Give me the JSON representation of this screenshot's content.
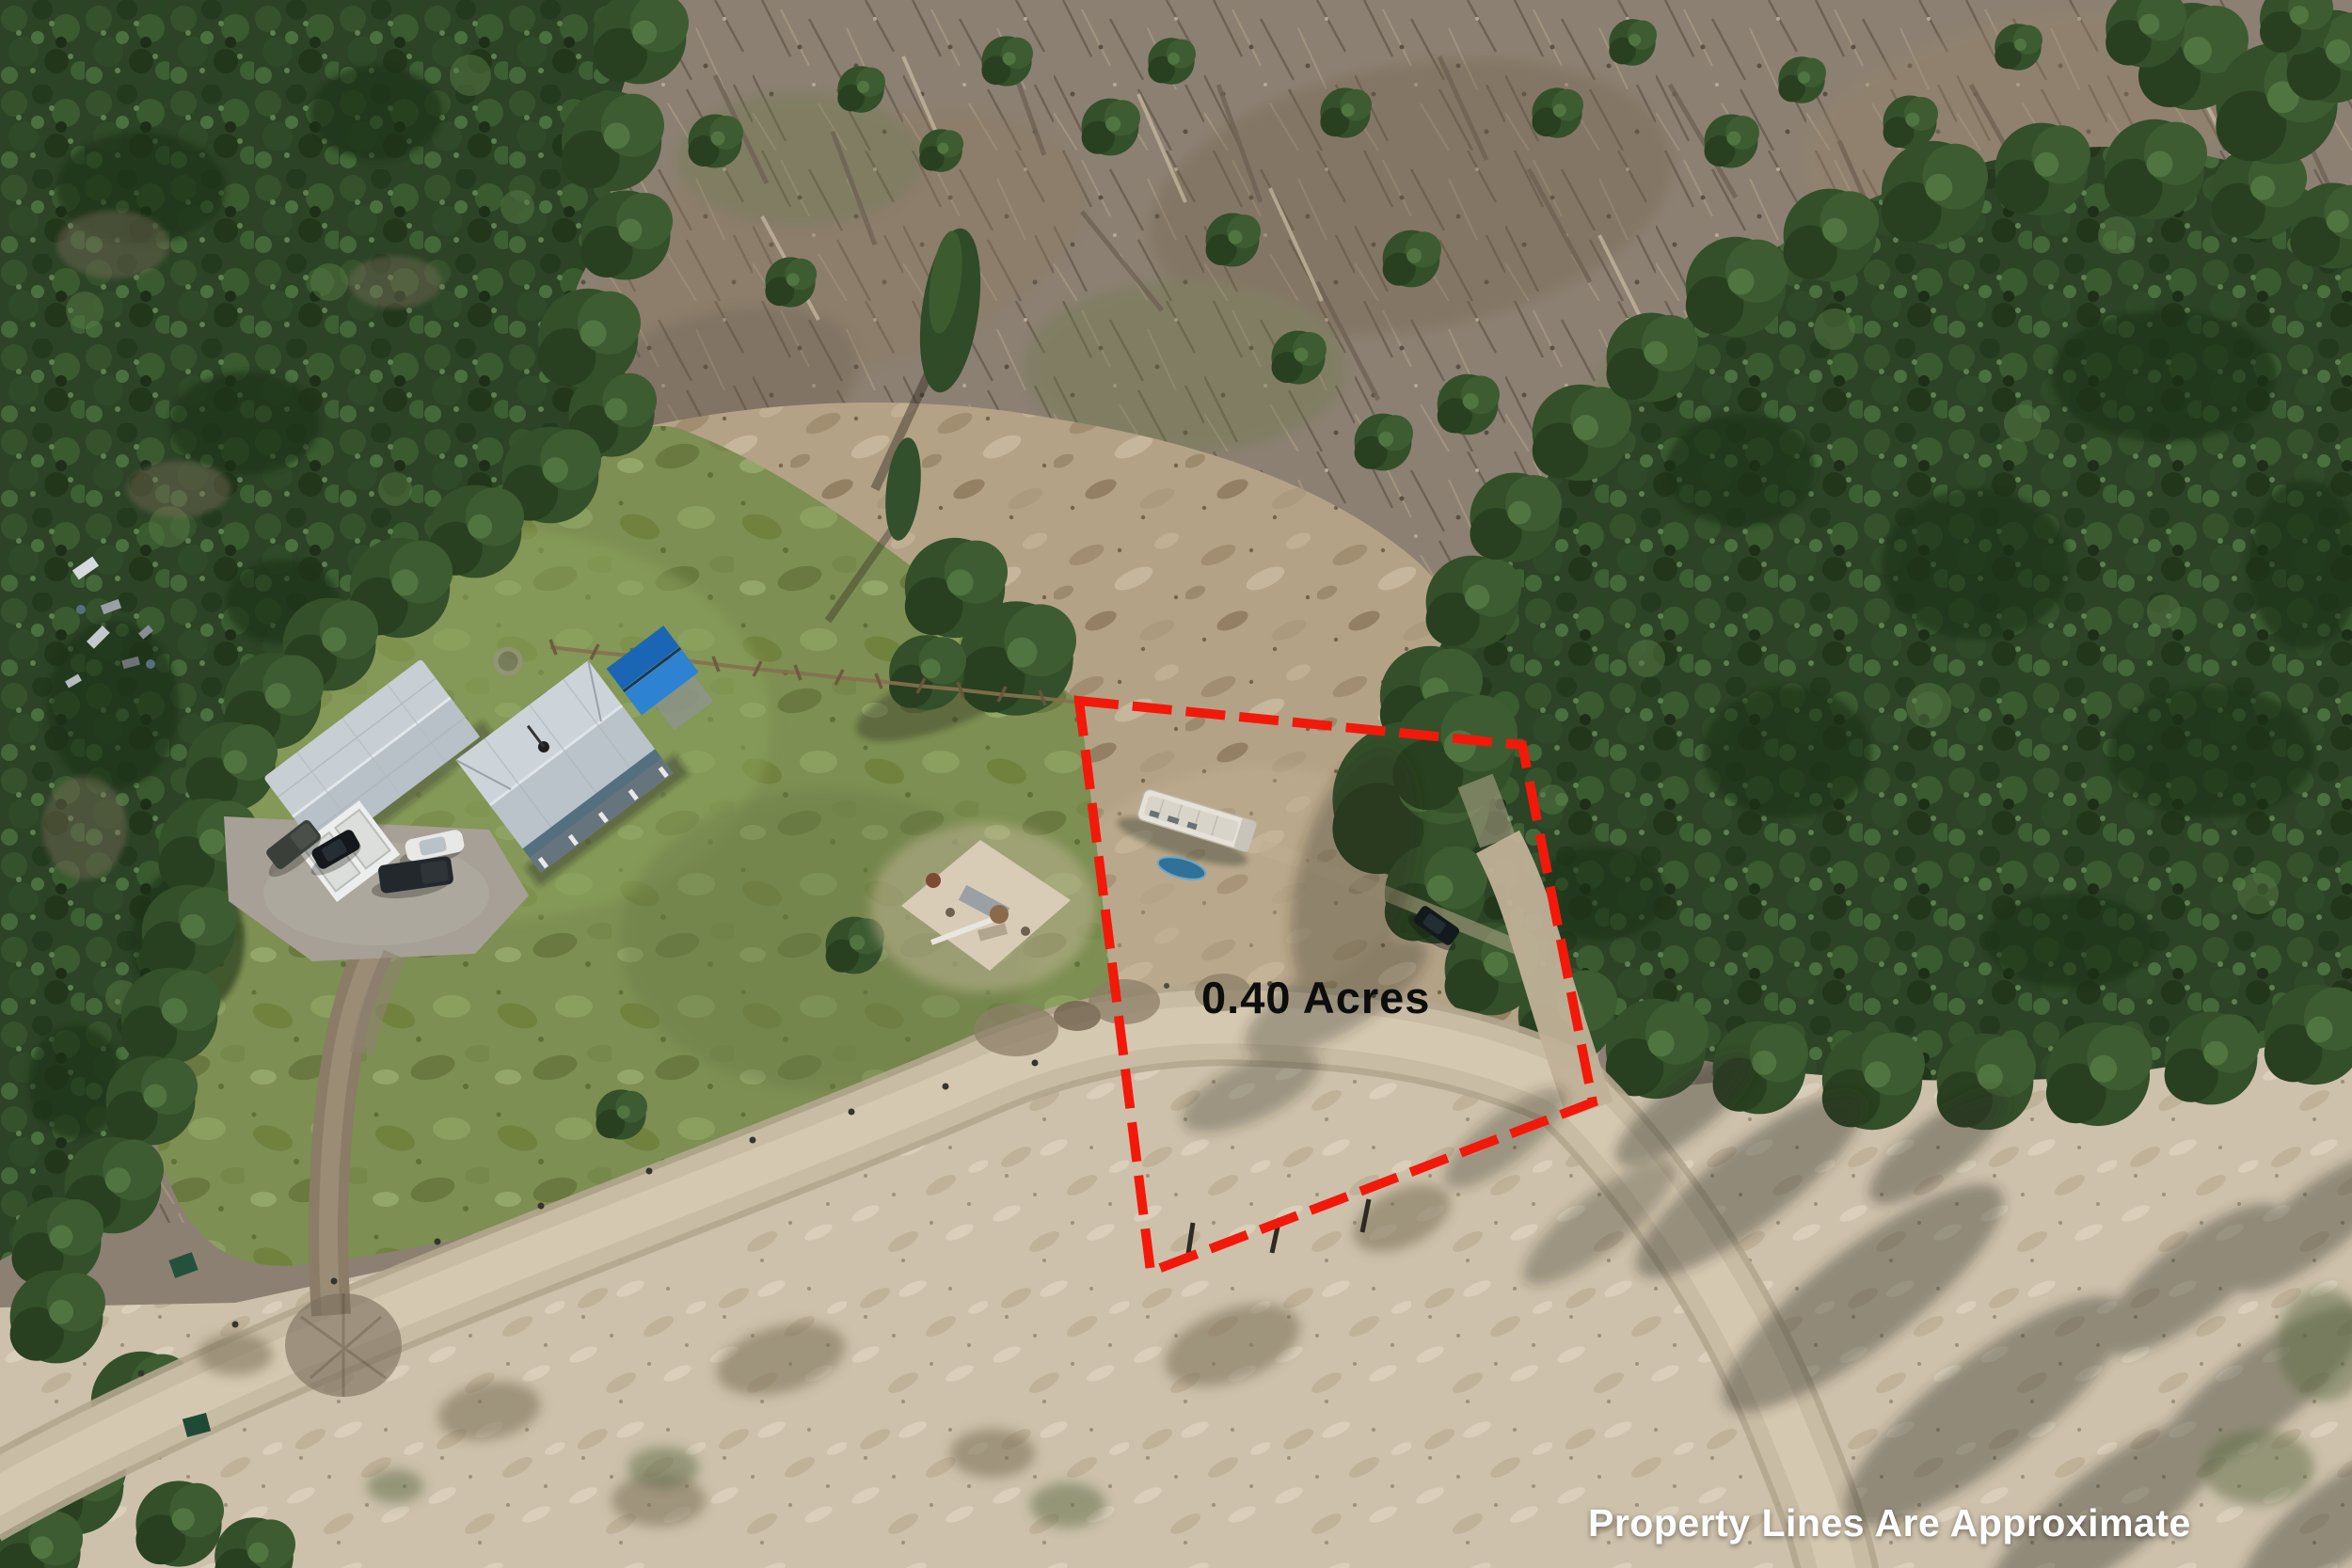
{
  "annotation": {
    "acreage_label": "0.40 Acres",
    "disclaimer": "Property Lines Are Approximate",
    "boundary_color": "#f2190a",
    "acreage_text_color": "#0d0d0d",
    "disclaimer_text_color": "#ffffff"
  },
  "photo": {
    "type": "aerial-drone-photo",
    "features": [
      "dense conifer forest upper-left and right",
      "logged brown hillside across the top",
      "green pasture with two metal-roof houses and blue-roof shed",
      "gravel driveway with four parked vehicles",
      "white RV trailer inside red-dashed 0.40 acre parcel",
      "dirt road curving past the parcel",
      "dry tan grass field in the foreground with tree shadows"
    ]
  }
}
